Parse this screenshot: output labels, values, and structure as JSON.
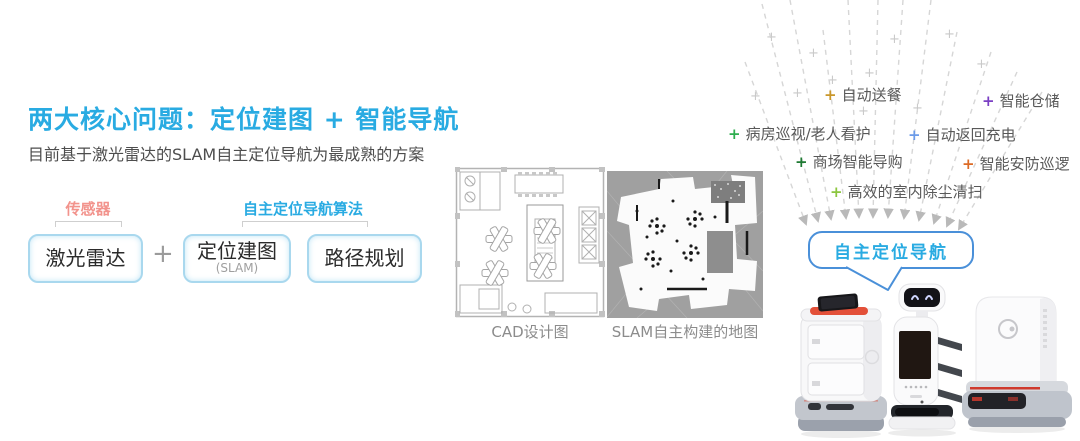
{
  "colors": {
    "accent_blue": "#29ABE2",
    "sensor_pink": "#F2938C",
    "bubble_border": "#4A90D9",
    "body_text": "#4D4D4D",
    "caption_gray": "#8C8C8C"
  },
  "header": {
    "title": "两大核心问题：定位建图 + 智能导航",
    "subtitle": "目前基于激光雷达的SLAM自主定位导航为最成熟的方案"
  },
  "pipeline": {
    "sensor_group_label": "传感器",
    "algorithm_group_label": "自主定位导航算法",
    "plus": "+",
    "boxes": [
      {
        "label": "激光雷达"
      },
      {
        "label": "定位建图",
        "sublabel": "(SLAM)"
      },
      {
        "label": "路径规划"
      }
    ]
  },
  "maps": {
    "cad_caption": "CAD设计图",
    "slam_caption": "SLAM自主构建的地图"
  },
  "applications": [
    {
      "label": "自动送餐",
      "marker": "+",
      "color": "#C9972B"
    },
    {
      "label": "智能仓储",
      "marker": "+",
      "color": "#7B3FC4"
    },
    {
      "label": "病房巡视/老人看护",
      "marker": "+",
      "color": "#2EAE4F"
    },
    {
      "label": "自动返回充电",
      "marker": "+",
      "color": "#6C9BE8"
    },
    {
      "label": "商场智能导购",
      "marker": "+",
      "color": "#1F7A33"
    },
    {
      "label": "智能安防巡逻",
      "marker": "+",
      "color": "#DC6B26"
    },
    {
      "label": "高效的室内除尘清扫",
      "marker": "+",
      "color": "#8CC63F"
    }
  ],
  "bubble": {
    "label": "自主定位导航"
  },
  "decor": {
    "plus_glyph": "+"
  }
}
